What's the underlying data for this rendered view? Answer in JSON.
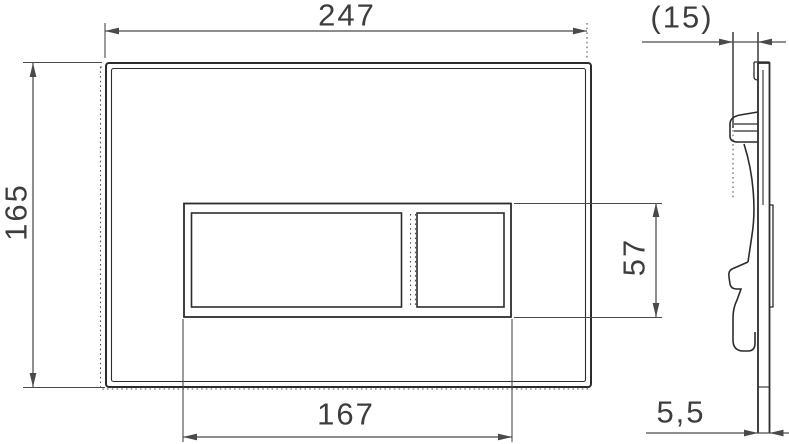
{
  "drawing": {
    "type": "technical dimension drawing, flush plate front and side view",
    "dimensions": {
      "plate_width": "247",
      "plate_height": "165",
      "button_area_width": "167",
      "button_area_height": "57",
      "depth_reference": "(15)",
      "plate_thickness": "5,5"
    },
    "colors": {
      "bg": "#ffffff",
      "line": "#2c2c2c",
      "dim": "#4a4a4a",
      "dash": "#555555",
      "text": "#3d3d3d"
    }
  }
}
